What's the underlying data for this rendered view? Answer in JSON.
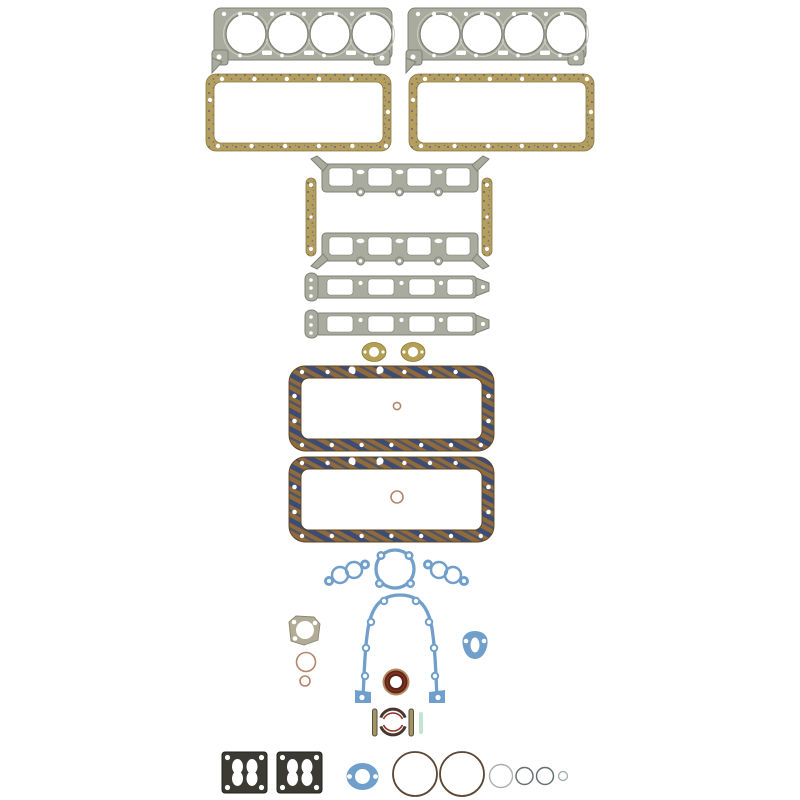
{
  "scene": {
    "background": "#ffffff",
    "description": "Complete engine overhaul gasket set laid out on a white background: two steel cylinder-head gaskets, two cork valve-cover gaskets, intake manifold gaskets with cork end seals, two exhaust manifold gaskets, two cork oil-pan gaskets, blue water-pump and timing-cover gaskets, seals, carburetor base gaskets and assorted O-rings."
  },
  "colors": {
    "steel": "#a9ab9e",
    "steelEdge": "#7f8276",
    "steelRing": "#c9ccc2",
    "cork": "#b59e5e",
    "corkBlue": "#4a5f93",
    "corkEdge": "#8a7a46",
    "panCork": "#8f6a3c",
    "panStripe": "#3c4c74",
    "panEdge": "#5f451f",
    "khaki": "#b3a055",
    "khakiEdge": "#8b7a38",
    "blue": "#6f9fca",
    "charcoal": "#3b3a33",
    "charcoalEdge": "#22221d",
    "sealTan": "#b5895f",
    "sealMaroon": "#5e2418",
    "sealRed": "#8d3425",
    "barTan": "#a39468",
    "barEdge": "#55503a",
    "teal": "#c2e4d2",
    "ringDark": "#5d4632",
    "ringGray": "#667070",
    "ringLight": "#aab0ac",
    "copper": "#b5846a",
    "thermo": "#b2ab96",
    "thermoEdge": "#8d8672"
  },
  "parts": [
    {
      "name": "cylinder-head-gasket",
      "qty": 2
    },
    {
      "name": "valve-cover-gasket",
      "qty": 2
    },
    {
      "name": "intake-manifold-gasket",
      "qty": 2
    },
    {
      "name": "intake-manifold-end-seal",
      "qty": 2
    },
    {
      "name": "exhaust-manifold-gasket",
      "qty": 2
    },
    {
      "name": "water-outlet-gasket",
      "qty": 2
    },
    {
      "name": "oil-pan-gasket",
      "qty": 2
    },
    {
      "name": "oil-pan-o-ring",
      "qty": 2
    },
    {
      "name": "water-pump-gasket",
      "qty": 2
    },
    {
      "name": "water-pump-backing-plate-gasket",
      "qty": 1
    },
    {
      "name": "timing-cover-gasket",
      "qty": 1
    },
    {
      "name": "thermostat-housing-gasket",
      "qty": 1
    },
    {
      "name": "fuel-pump-mounting-gasket",
      "qty": 1
    },
    {
      "name": "front-crankshaft-seal",
      "qty": 1
    },
    {
      "name": "rear-main-seal",
      "qty": 1
    },
    {
      "name": "rear-main-side-seal",
      "qty": 2
    },
    {
      "name": "carburetor-base-gasket",
      "qty": 2
    },
    {
      "name": "mounting-pad-gasket",
      "qty": 1
    },
    {
      "name": "o-ring-seal",
      "qty": 6
    }
  ]
}
